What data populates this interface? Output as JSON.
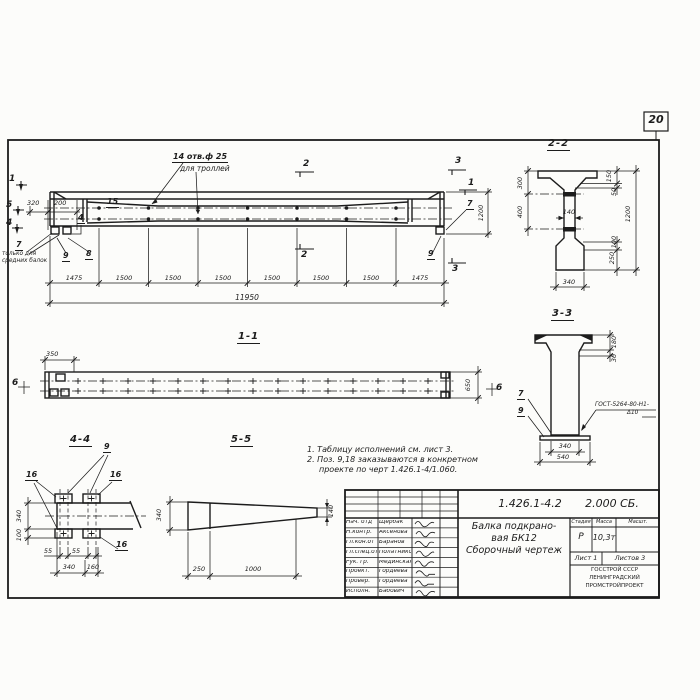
{
  "sheet": {
    "number": "20"
  },
  "elevation": {
    "markers": {
      "m1": "1",
      "m5": "5",
      "m4": "4",
      "m2a": "2",
      "m2b": "2",
      "m3a": "3",
      "m3b": "3",
      "m1r": "1"
    },
    "dims": {
      "d320": "320",
      "d200": "200",
      "d1200": "1200",
      "total": "11950",
      "segments": [
        "1475",
        "1500",
        "1500",
        "1500",
        "1500",
        "1500",
        "1500",
        "1475"
      ]
    },
    "holes_note": {
      "l1": "14 отв.ф 25",
      "l2": "для троллей"
    },
    "pos": {
      "p15": "15",
      "p4": "4",
      "p7": "7",
      "p8": "8",
      "p9": "9",
      "p7r": "7",
      "p9r": "9",
      "p7_note1": "только для",
      "p7_note2": "средних балок"
    }
  },
  "sec22": {
    "title": "2-2",
    "d300": "300",
    "d400": "400",
    "d150": "150",
    "d50": "50",
    "d1200": "1200",
    "d100": "100",
    "d250": "250",
    "d140": "140",
    "d340": "340"
  },
  "sec33": {
    "title": "3-3",
    "d180": "180",
    "d30": "30",
    "d340": "340",
    "d540": "540",
    "p7": "7",
    "p9": "9",
    "weld1": "ГОСТ-5264-80-Н1-",
    "weld2": "Δ10"
  },
  "sec11": {
    "title": "1-1",
    "d350": "350",
    "d650": "650",
    "m6l": "6",
    "m6r": "6"
  },
  "sec44": {
    "title": "4-4",
    "p9": "9",
    "p16l": "16",
    "p16r": "16",
    "p16b": "16",
    "d340v": "340",
    "d100": "100",
    "d55a": "55",
    "d55b": "55",
    "d340b": "340",
    "d160": "160"
  },
  "sec55": {
    "title": "5-5",
    "d340": "340",
    "d140": "140",
    "d250": "250",
    "d1000": "1000"
  },
  "notes": {
    "l1": "1. Таблицу исполнений см. лист 3.",
    "l2": "2. Поз. 9,18 заказываются в конкретном",
    "l3": "проекте по черт 1.426.1-4/1.060."
  },
  "stamp": {
    "doc_number": "1.426.1-4.2",
    "doc_code": "2.000 СБ.",
    "rows": [
      {
        "role": "Нач. отд",
        "name": "Щербак"
      },
      {
        "role": "Н.контр.",
        "name": "Аксенова"
      },
      {
        "role": "Гл.кон.от",
        "name": "Баранов"
      },
      {
        "role": "Гл.спец.от",
        "name": "Полатников"
      },
      {
        "role": "Рук. гр.",
        "name": "Мединская"
      },
      {
        "role": "Проект.",
        "name": "Гордеева"
      },
      {
        "role": "Провер.",
        "name": "Гордеева"
      },
      {
        "role": "Исполн.",
        "name": "Бабович"
      }
    ],
    "title1": "Балка подкрано-",
    "title2": "вая БК12",
    "title3": "Сборочный чертеж",
    "h_stage": "Стадия",
    "h_mass": "Масса",
    "h_scale": "Масшт.",
    "stage": "Р",
    "mass": "10,3т",
    "sheet": "Лист 1",
    "sheets": "Листов 3",
    "org1": "ГОССТРОЙ СССР",
    "org2": "ЛЕНИНГРАДСКИЙ",
    "org3": "ПРОМСТРОЙПРОЕКТ"
  }
}
